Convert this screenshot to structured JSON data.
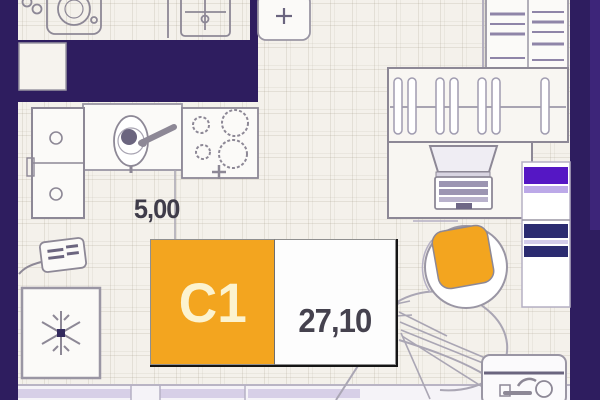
{
  "plan": {
    "unit": {
      "code": "C1",
      "area": "27,10"
    },
    "dimension": {
      "value": "5,00"
    },
    "colors": {
      "wall": "#2E1D5F",
      "accent_orange": "#F3A51F",
      "violet": "#5517C4",
      "navy": "#2B2B70",
      "floor": "#F4F1EB",
      "glass": "#D7CFE7",
      "outline": "#8D8896",
      "dim_text": "#3F3C49",
      "unit_text": "#FCF3CF"
    },
    "fixtures": [
      "washing-machine",
      "bathroom-sink",
      "kitchen-cabinet",
      "kitchen-sink",
      "faucet",
      "stove",
      "electric-panel",
      "fridge",
      "ac-unit",
      "shelf-cabinet",
      "wardrobe-with-hangers",
      "desk",
      "laptop",
      "right-storage",
      "armchair",
      "lounge",
      "vanity-sink",
      "window-band"
    ]
  }
}
